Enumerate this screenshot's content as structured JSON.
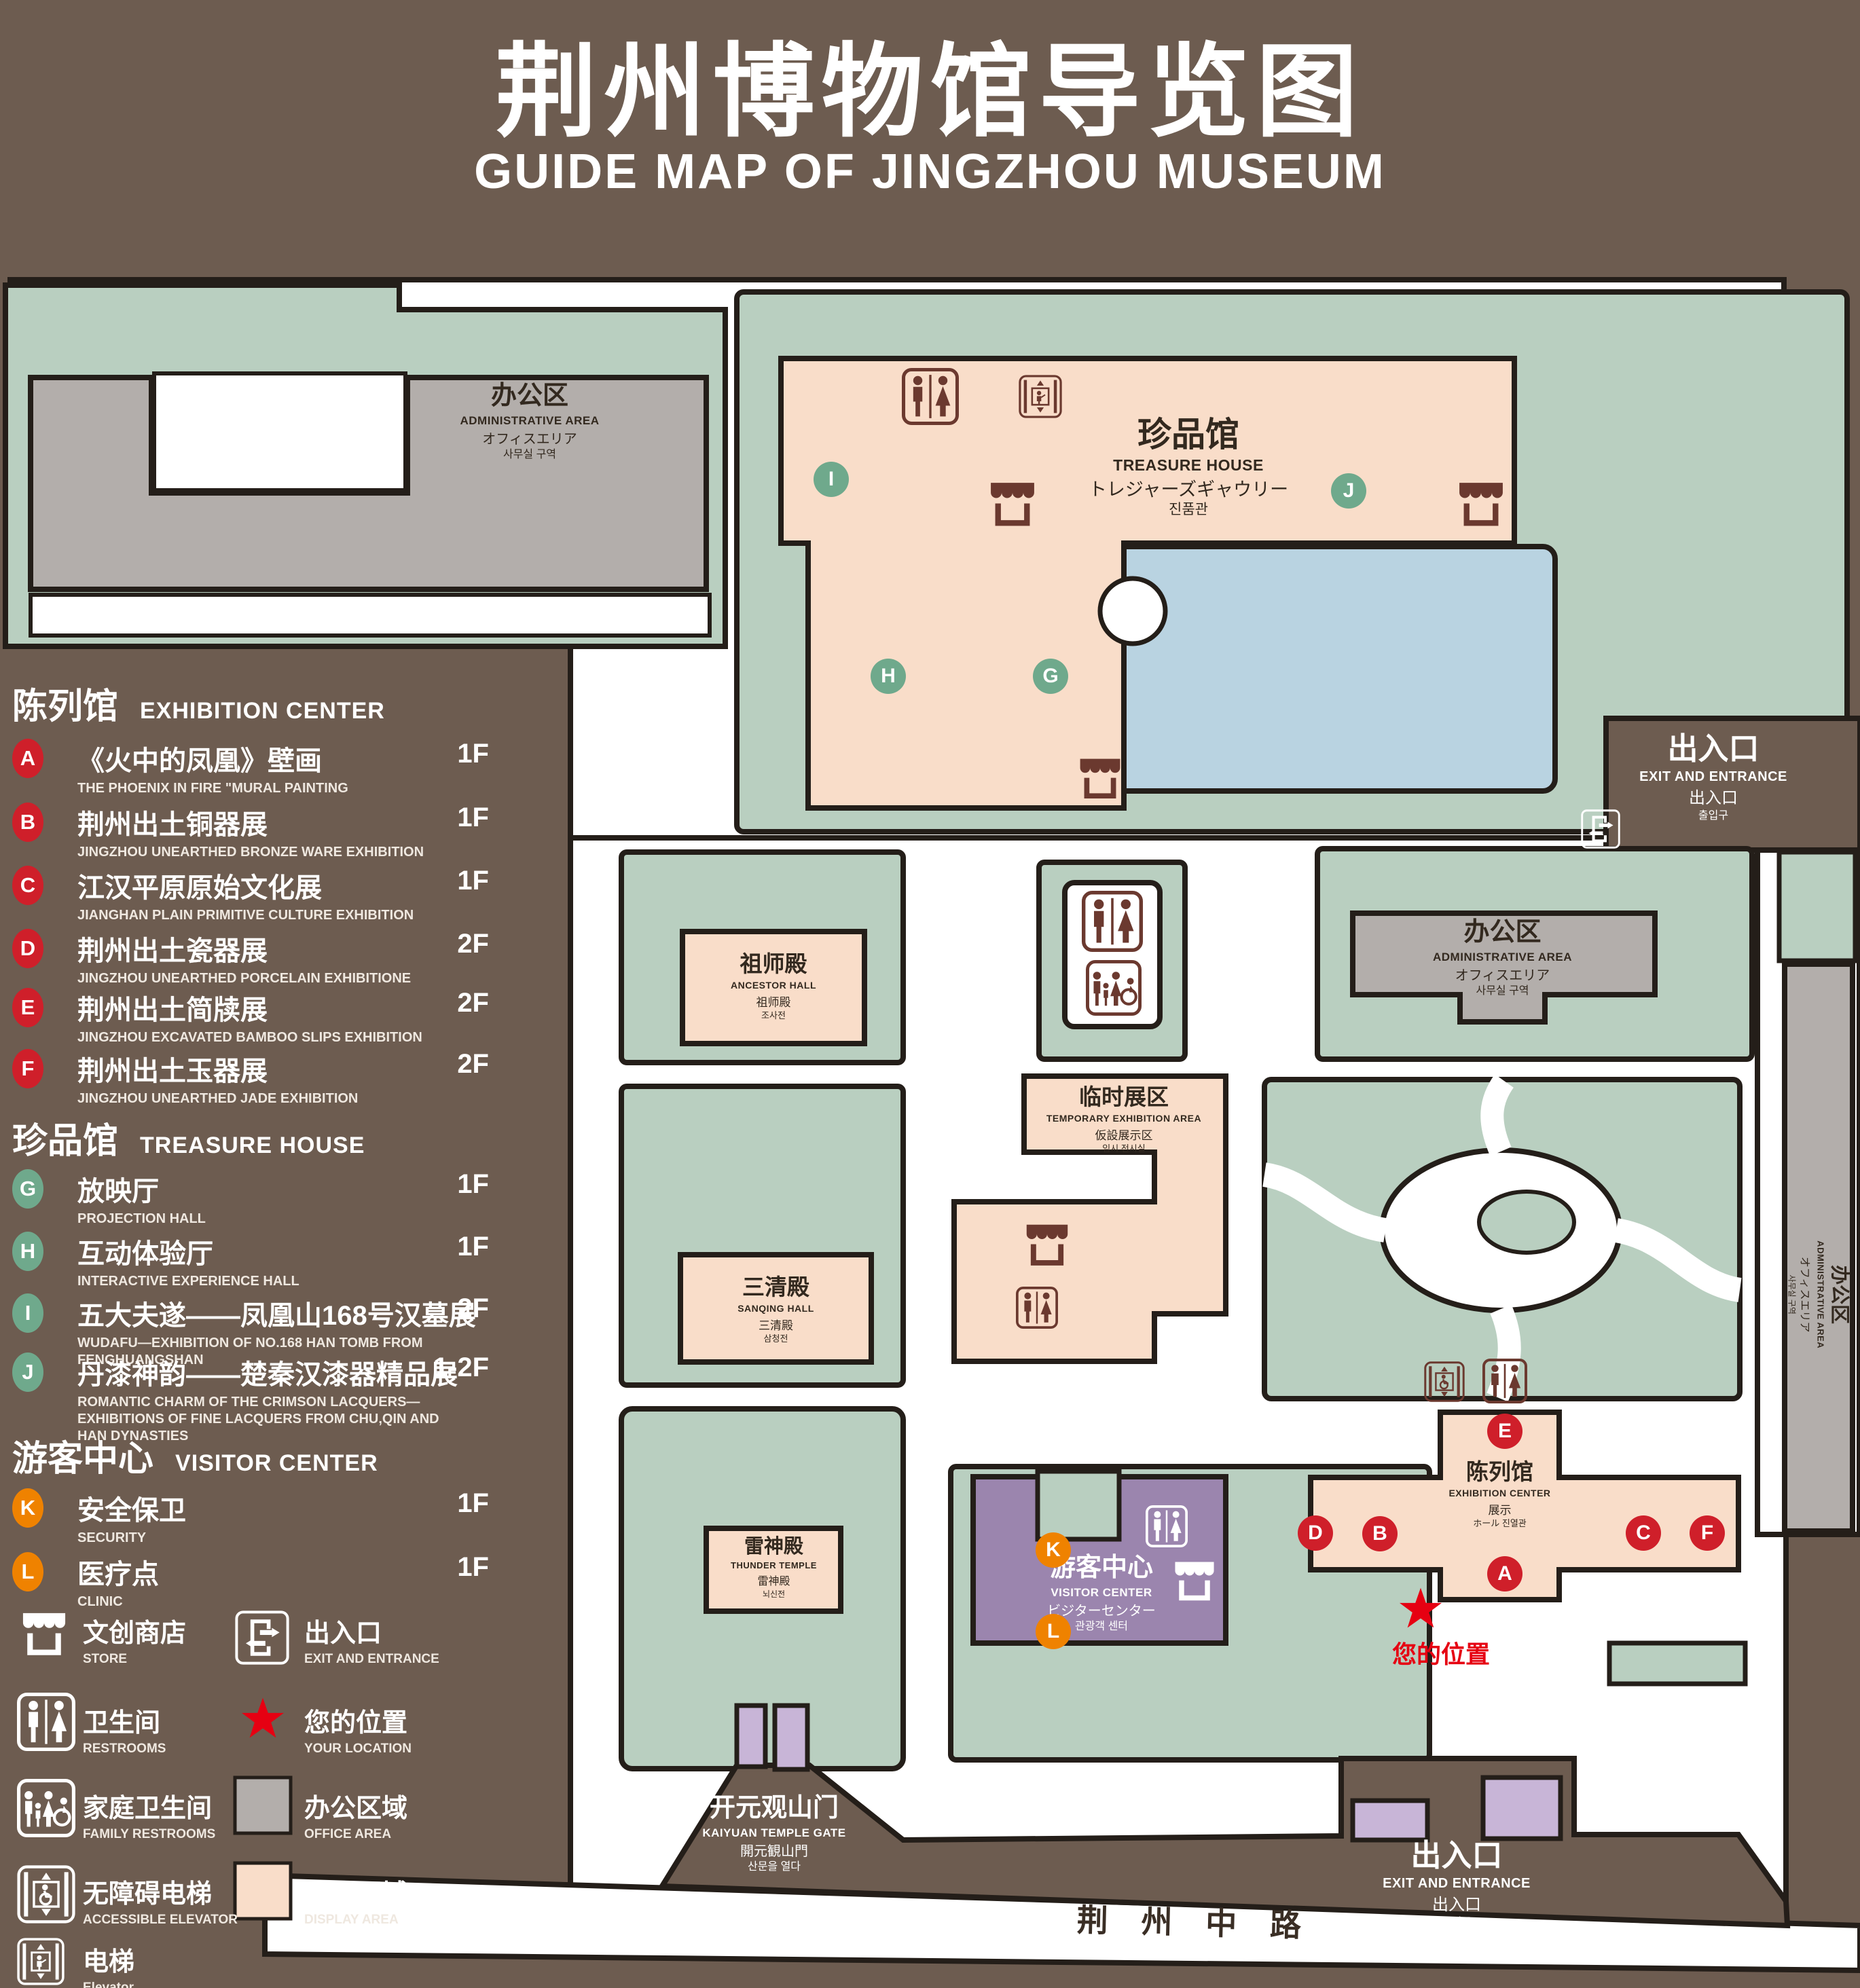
{
  "title": {
    "zh": "荆州博物馆导览图",
    "en": "GUIDE MAP OF JINGZHOU MUSEUM"
  },
  "legend": {
    "sections": [
      {
        "zh": "陈列馆",
        "en": "EXHIBITION CENTER",
        "badge_color": "#cf1f2a",
        "items": [
          {
            "letter": "A",
            "zh": "《火中的凤凰》壁画",
            "en": "THE PHOENIX IN FIRE \"MURAL PAINTING",
            "floor": "1F"
          },
          {
            "letter": "B",
            "zh": "荆州出土铜器展",
            "en": "JINGZHOU UNEARTHED BRONZE WARE EXHIBITION",
            "floor": "1F"
          },
          {
            "letter": "C",
            "zh": "江汉平原原始文化展",
            "en": "JIANGHAN PLAIN PRIMITIVE CULTURE EXHIBITION",
            "floor": "1F"
          },
          {
            "letter": "D",
            "zh": "荆州出土瓷器展",
            "en": "JINGZHOU UNEARTHED PORCELAIN EXHIBITIONE",
            "floor": "2F"
          },
          {
            "letter": "E",
            "zh": "荆州出土简牍展",
            "en": "JINGZHOU EXCAVATED BAMBOO SLIPS EXHIBITION",
            "floor": "2F"
          },
          {
            "letter": "F",
            "zh": "荆州出土玉器展",
            "en": "JINGZHOU UNEARTHED JADE EXHIBITION",
            "floor": "2F"
          }
        ]
      },
      {
        "zh": "珍品馆",
        "en": "TREASURE HOUSE",
        "badge_color": "#6fa98c",
        "items": [
          {
            "letter": "G",
            "zh": "放映厅",
            "en": "PROJECTION HALL",
            "floor": "1F"
          },
          {
            "letter": "H",
            "zh": "互动体验厅",
            "en": "INTERACTIVE EXPERIENCE HALL",
            "floor": "1F"
          },
          {
            "letter": "I",
            "zh": "五大夫遂——凤凰山168号汉墓展",
            "en": "WUDAFU—EXHIBITION OF NO.168 HAN TOMB FROM FENGHUANGSHAN",
            "floor": "2F"
          },
          {
            "letter": "J",
            "zh": "丹漆神韵——楚秦汉漆器精品展",
            "en": "ROMANTIC CHARM OF THE CRIMSON LACQUERS—EXHIBITIONS OF FINE LACQUERS FROM CHU,QIN AND HAN DYNASTIES",
            "floor": "1-2F"
          }
        ]
      },
      {
        "zh": "游客中心",
        "en": "VISITOR CENTER",
        "badge_color": "#ef8200",
        "items": [
          {
            "letter": "K",
            "zh": "安全保卫",
            "en": "SECURITY",
            "floor": "1F"
          },
          {
            "letter": "L",
            "zh": "医疗点",
            "en": "CLINIC",
            "floor": "1F"
          }
        ]
      }
    ],
    "symbols": [
      {
        "icon": "store-icon",
        "zh": "文创商店",
        "en": "STORE"
      },
      {
        "icon": "restrooms-icon",
        "zh": "卫生间",
        "en": "RESTROOMS"
      },
      {
        "icon": "family-restrooms-icon",
        "zh": "家庭卫生间",
        "en": "FAMILY RESTROOMS"
      },
      {
        "icon": "accessible-elevator-icon",
        "zh": "无障碍电梯",
        "en": "ACCESSIBLE ELEVATOR"
      },
      {
        "icon": "elevator-icon",
        "zh": "电梯",
        "en": "Elevator"
      },
      {
        "icon": "exit-icon",
        "zh": "出入口",
        "en": "EXIT AND ENTRANCE"
      },
      {
        "icon": "your-location-star",
        "zh": "您的位置",
        "en": "YOUR LOCATION"
      },
      {
        "icon": "office-area-swatch",
        "zh": "办公区域",
        "en": "OFFICE AREA"
      },
      {
        "icon": "display-area-swatch",
        "zh": "展示区域",
        "en": "DISPLAY AREA"
      }
    ]
  },
  "map": {
    "buildings": {
      "admin_top_left": {
        "zh": "办公区",
        "en": "ADMINISTRATIVE AREA",
        "ja": "オフィスエリア",
        "ko": "사무실 구역"
      },
      "treasure_house": {
        "zh": "珍品馆",
        "en": "TREASURE HOUSE",
        "ja": "トレジャーズギャウリー",
        "ko": "진품관"
      },
      "ancestor_hall": {
        "zh": "祖师殿",
        "en": "ANCESTOR HALL",
        "ja": "祖师殿",
        "ko": "조사전"
      },
      "temporary_exhibition": {
        "zh": "临时展区",
        "en": "TEMPORARY EXHIBITION AREA",
        "ja": "仮設展示区",
        "ko": "임시 전시실"
      },
      "admin_right": {
        "zh": "办公区",
        "en": "ADMINISTRATIVE AREA",
        "ja": "オフィスエリア",
        "ko": "사무실 구역"
      },
      "admin_right_strip": {
        "zh": "办公区",
        "en": "ADMINISTRATIVE AREA",
        "ja": "オフィスエリア",
        "ko": "사무실 구역"
      },
      "sanqing_hall": {
        "zh": "三清殿",
        "en": "SANQING HALL",
        "ja": "三清殿",
        "ko": "삼청전"
      },
      "thunder_temple": {
        "zh": "雷神殿",
        "en": "THUNDER TEMPLE",
        "ja": "雷神殿",
        "ko": "뇌신전"
      },
      "visitor_center": {
        "zh": "游客中心",
        "en": "VISITOR CENTER",
        "ja": "ビジターセンター",
        "ko": "관광객 센터"
      },
      "exhibition_center": {
        "zh": "陈列馆",
        "en": "EXHIBITION CENTER",
        "ja": "展示",
        "ko": "ホール 진열관"
      }
    },
    "exits": {
      "top_right": {
        "zh": "出入口",
        "en": "EXIT AND ENTRANCE",
        "ja": "出入口",
        "ko": "출입구"
      },
      "bottom": {
        "zh": "出入口",
        "en": "EXIT AND ENTRANCE",
        "ja": "出入口",
        "ko": "출입구"
      }
    },
    "gate": {
      "zh": "开元观山门",
      "en": "KAIYUAN TEMPLE GATE",
      "ja": "開元観山門",
      "ko": "산문을 열다"
    },
    "road": {
      "zh": "荆 州 中 路"
    },
    "your_location": {
      "zh": "您的位置"
    }
  },
  "colors": {
    "background": "#6d5c50",
    "lawn": "#b9cfc0",
    "office_area": "#b3aeab",
    "display_area": "#f9ddc9",
    "visitor_center": "#9b85ae",
    "entrance_block": "#c8b5d7",
    "pond": "#b9d3e1",
    "badge_red": "#cf1f2a",
    "badge_green": "#6fa98c",
    "badge_orange": "#ef8200",
    "location_red": "#e60012"
  }
}
